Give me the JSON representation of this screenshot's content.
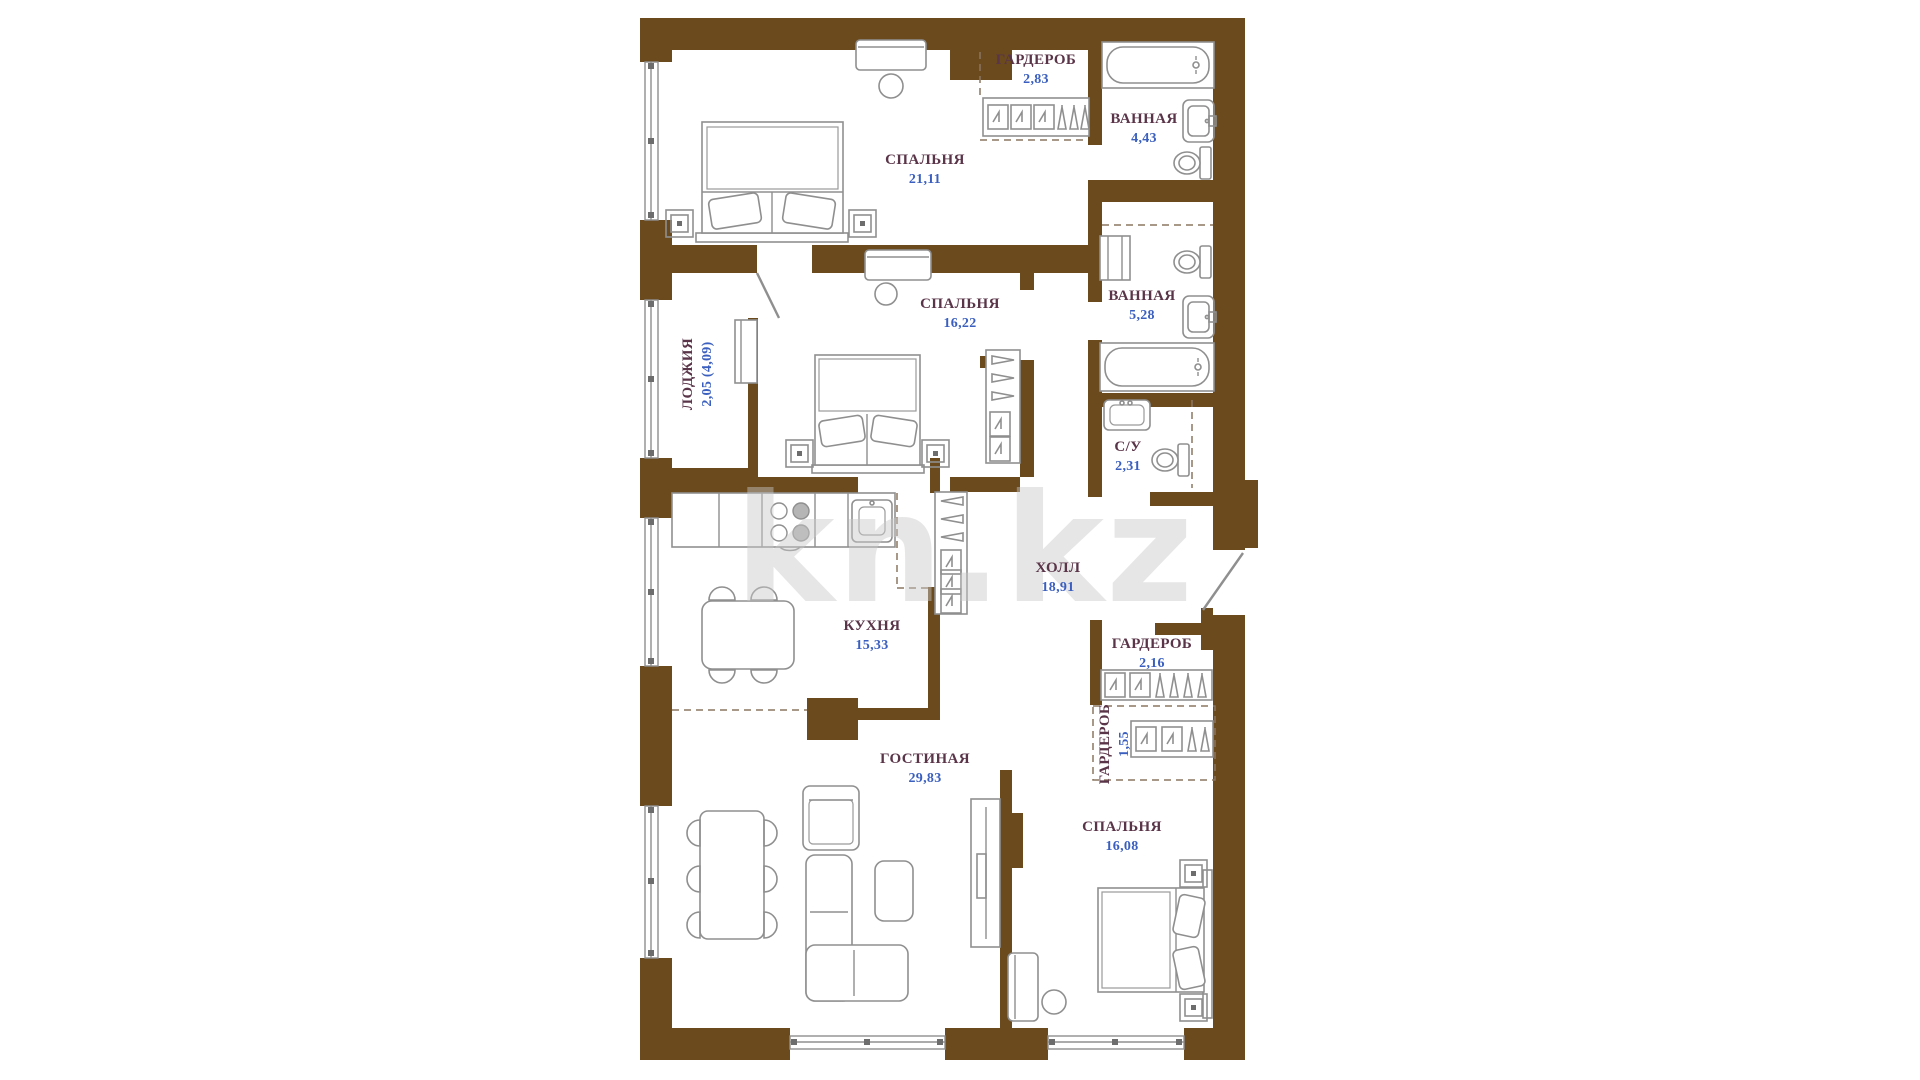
{
  "watermark": "kn.kz",
  "colors": {
    "wall": "#6B4A1E",
    "furniture_stroke": "#8f8f8f",
    "room_name_text": "#5a3448",
    "room_area_text": "#3a5fbf",
    "watermark_text": "#c9c9c9",
    "background": "#ffffff"
  },
  "plan_type": "apartment-floor-plan",
  "rooms": [
    {
      "id": "bedroom-1",
      "name": "СПАЛЬНЯ",
      "area": "21,11"
    },
    {
      "id": "wardrobe-1",
      "name": "ГАРДЕРОБ",
      "area": "2,83"
    },
    {
      "id": "bathroom-1",
      "name": "ВАННАЯ",
      "area": "4,43"
    },
    {
      "id": "bedroom-2",
      "name": "СПАЛЬНЯ",
      "area": "16,22"
    },
    {
      "id": "loggia",
      "name": "ЛОДЖИЯ",
      "area": "2,05 (4,09)"
    },
    {
      "id": "bathroom-2",
      "name": "ВАННАЯ",
      "area": "5,28"
    },
    {
      "id": "wc",
      "name": "С/У",
      "area": "2,31"
    },
    {
      "id": "hall",
      "name": "ХОЛЛ",
      "area": "18,91"
    },
    {
      "id": "kitchen",
      "name": "КУХНЯ",
      "area": "15,33"
    },
    {
      "id": "wardrobe-2",
      "name": "ГАРДЕРОБ",
      "area": "2,16"
    },
    {
      "id": "wardrobe-3",
      "name": "ГАРДЕРОБ",
      "area": "1,55"
    },
    {
      "id": "living-room",
      "name": "ГОСТИНАЯ",
      "area": "29,83"
    },
    {
      "id": "bedroom-3",
      "name": "СПАЛЬНЯ",
      "area": "16,08"
    }
  ],
  "furniture": {
    "bedroom-1": [
      "double-bed",
      "two-nightstands",
      "dresser",
      "mirror-stool"
    ],
    "bedroom-2": [
      "double-bed",
      "two-nightstands",
      "dresser",
      "mirror-stool",
      "open-wardrobe-rack"
    ],
    "bedroom-3": [
      "double-bed",
      "two-nightstands",
      "dresser",
      "stool"
    ],
    "wardrobe-1": [
      "shelving-with-hangers"
    ],
    "wardrobe-2": [
      "shelving-with-hangers"
    ],
    "wardrobe-3": [
      "shelving-with-hangers"
    ],
    "bathroom-1": [
      "bathtub",
      "wash-basin",
      "toilet"
    ],
    "bathroom-2": [
      "bathtub",
      "wash-basin",
      "toilet",
      "washer-cabinet"
    ],
    "wc": [
      "wash-basin",
      "toilet"
    ],
    "kitchen": [
      "kitchen-counter",
      "cooktop",
      "sink",
      "dining-table-4-chairs"
    ],
    "hall": [
      "open-closet-rack",
      "entrance-door"
    ],
    "living-room": [
      "dining-table-6-chairs",
      "armchair",
      "corner-sofa",
      "coffee-table",
      "tv-stand"
    ],
    "loggia": [
      "cabinet",
      "balcony-door"
    ]
  }
}
